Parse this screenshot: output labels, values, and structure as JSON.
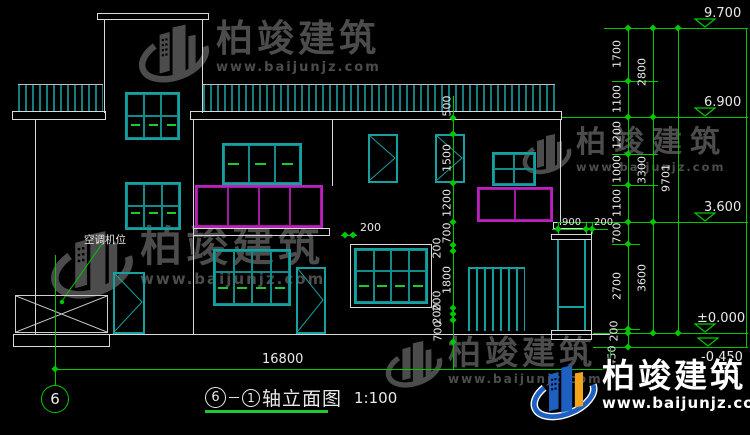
{
  "watermark": {
    "brand": "柏竣建筑",
    "url": "www.baijunjz.com"
  },
  "notes": {
    "ac": "空调机位"
  },
  "dims": {
    "bottom_total": "16800",
    "overhang": "200",
    "porch": [
      "900",
      "200"
    ],
    "right_col1": [
      "1700",
      "1100",
      "1200",
      "1000",
      "1100",
      "700",
      "2700",
      "200",
      "450"
    ],
    "right_col2": [
      "2800",
      "3300",
      "3600"
    ],
    "right_total": "9701",
    "mid_chain": [
      "500",
      "1500",
      "1200",
      "700",
      "200",
      "1800",
      "200",
      "200",
      "700"
    ],
    "levels": [
      "9.700",
      "6.900",
      "3.600",
      "±0.000",
      "-0.450"
    ]
  },
  "title": {
    "axis_left": "6",
    "axis_sep": "－",
    "axis_right": "1",
    "name": "轴立面图",
    "scale": "1:100",
    "bubble": "6"
  },
  "chart_colors": {
    "teal": "#17a0a0",
    "green": "#00c800",
    "magenta": "#bb22bb",
    "white": "#d9d9d9"
  }
}
